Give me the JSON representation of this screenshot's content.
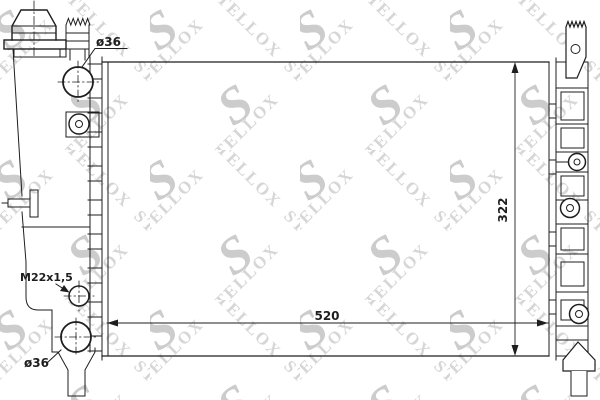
{
  "watermark": {
    "text": "STELLOX",
    "logo": "S"
  },
  "labels": {
    "top_port_diameter": "ø36",
    "drain_plug_thread": "M22x1,5",
    "bottom_port_diameter": "ø36"
  },
  "dimensions": {
    "core_width_mm": "520",
    "core_height_mm": "322"
  },
  "colors": {
    "background": "#ffffff",
    "line": "#1e1e1e",
    "watermark_text": "#d6d6d6",
    "watermark_logo": "#cccccc"
  }
}
